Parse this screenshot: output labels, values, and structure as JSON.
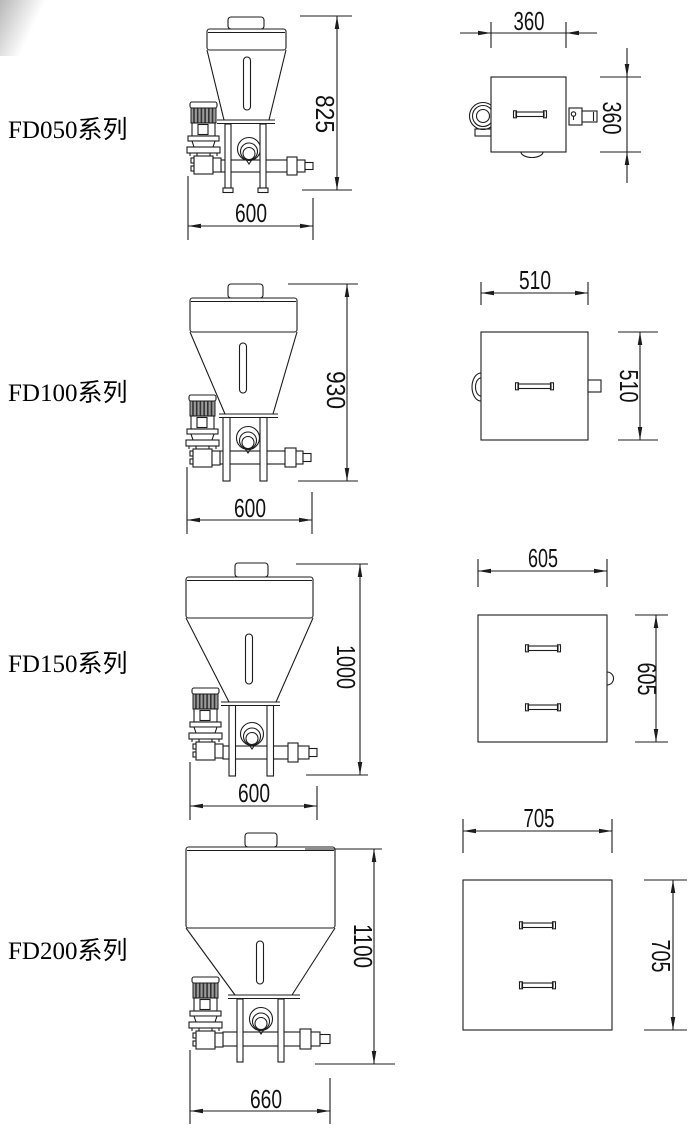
{
  "page": {
    "background": "#ffffff",
    "line_color": "#1c1c1c",
    "artifact_color": "#8c8c8c"
  },
  "rows": [
    {
      "series_label": "FD050系列",
      "front_view": {
        "height_mm": "825",
        "width_mm": "600"
      },
      "top_view": {
        "width_mm": "360",
        "depth_mm": "360"
      }
    },
    {
      "series_label": "FD100系列",
      "front_view": {
        "height_mm": "930",
        "width_mm": "600"
      },
      "top_view": {
        "width_mm": "510",
        "depth_mm": "510"
      }
    },
    {
      "series_label": "FD150系列",
      "front_view": {
        "height_mm": "1000",
        "width_mm": "600"
      },
      "top_view": {
        "width_mm": "605",
        "depth_mm": "605"
      }
    },
    {
      "series_label": "FD200系列",
      "front_view": {
        "height_mm": "1100",
        "width_mm": "660"
      },
      "top_view": {
        "width_mm": "705",
        "depth_mm": "705"
      }
    }
  ]
}
